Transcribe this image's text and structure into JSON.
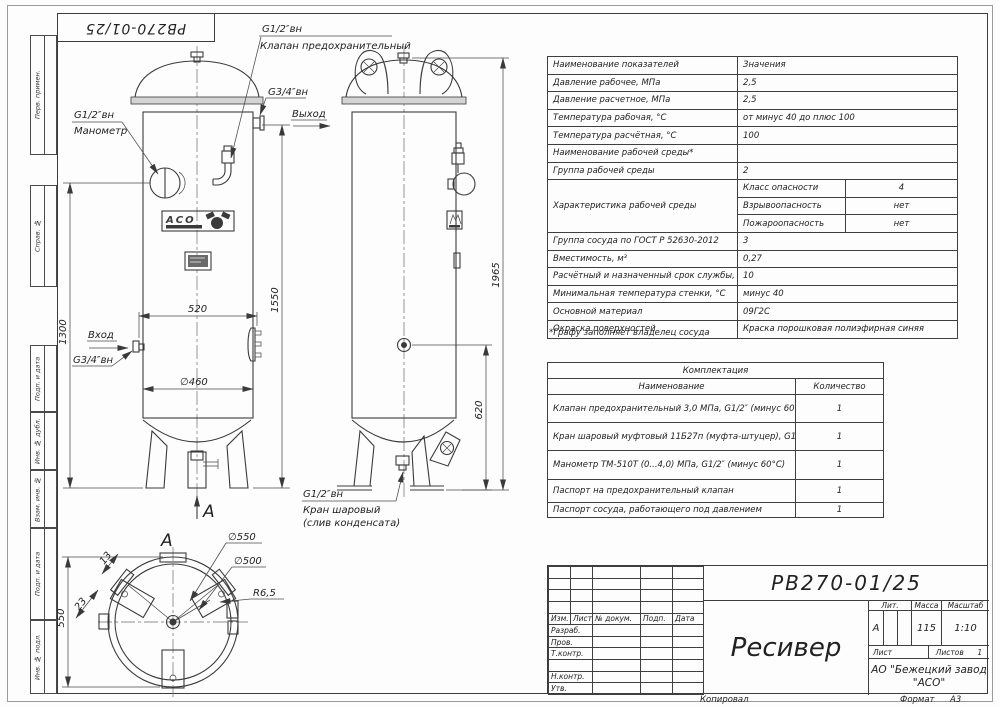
{
  "stamp_top": "РВ270-01/25",
  "margin_labels": [
    "Перв. примен.",
    "Справ. №",
    "Подп. и дата",
    "Инв. № дубл.",
    "Взам. инв. №",
    "Подп. и дата",
    "Инв. № подл."
  ],
  "specs": {
    "rows": [
      {
        "label": "Наименование показателей",
        "value": "Значения"
      },
      {
        "label": "Давление рабочее, МПа",
        "value": "2,5"
      },
      {
        "label": "Давление расчетное, МПа",
        "value": "2,5"
      },
      {
        "label": "Температура рабочая, °С",
        "value": "от минус 40 до плюс 100"
      },
      {
        "label": "Температура расчётная, °С",
        "value": "100"
      },
      {
        "label": "Наименование рабочей среды*",
        "value": ""
      },
      {
        "label": "Группа рабочей среды",
        "value": "2"
      }
    ],
    "group_label": "Характеристика рабочей среды",
    "group_rows": [
      {
        "label": "Класс опасности",
        "value": "4"
      },
      {
        "label": "Взрывоопасность",
        "value": "нет"
      },
      {
        "label": "Пожароопасность",
        "value": "нет"
      }
    ],
    "rows2": [
      {
        "label": "Группа сосуда по ГОСТ Р 52630-2012",
        "value": "3"
      },
      {
        "label": "Вместимость, м³",
        "value": "0,27"
      },
      {
        "label": "Расчётный и назначенный срок службы, лет",
        "value": "10"
      },
      {
        "label": "Минимальная температура стенки, °С",
        "value": "минус 40"
      },
      {
        "label": "Основной материал",
        "value": "09Г2С"
      },
      {
        "label": "Окраска поверхностей",
        "value": "Краска порошковая полиэфирная синяя"
      }
    ],
    "footnote": "*Графу заполняет владелец сосуда"
  },
  "kit": {
    "title": "Комплектация",
    "header": {
      "name": "Наименование",
      "qty": "Количество"
    },
    "rows": [
      {
        "name": "Клапан предохранительный 3,0 МПа, G1/2″ (минус 60°С)",
        "qty": "1"
      },
      {
        "name": "Кран шаровый муфтовый 11Б27п (муфта-штуцер), G1/2″",
        "qty": "1"
      },
      {
        "name": "Манометр ТМ-510Т (0...4,0) МПа, G1/2″ (минус 60°С)",
        "qty": "1"
      },
      {
        "name": "Паспорт на предохранительный клапан",
        "qty": "1"
      },
      {
        "name": "Паспорт сосуда, работающего под давлением",
        "qty": "1"
      }
    ]
  },
  "title_block": {
    "doc_number": "РВ270-01/25",
    "title": "Ресивер",
    "col_headers": [
      "Изм.",
      "Лист",
      "№ докум.",
      "Подп.",
      "Дата"
    ],
    "row_labels": [
      "Разраб.",
      "Пров.",
      "Т.контр.",
      "Н.контр.",
      "Утв."
    ],
    "lit_label": "Лит.",
    "mass_label": "Масса",
    "scale_label": "Масштаб",
    "lit": "А",
    "mass": "115",
    "scale": "1:10",
    "sheet_label": "Лист",
    "sheets_label": "Листов",
    "sheets": "1",
    "company_line1": "АО \"Бежецкий завод",
    "company_line2": "\"АСО\"",
    "copied_label": "Копировал",
    "format_label": "Формат",
    "format": "А3"
  },
  "drawing": {
    "section": "А",
    "logo": "АСО",
    "callouts": {
      "valve_size": "G1/2″вн",
      "valve_name": "Клапан предохранительный",
      "mano_size": "G1/2″вн",
      "mano_name": "Манометр",
      "outlet_size": "G3/4″вн",
      "outlet": "Выход",
      "inlet": "Вход",
      "inlet_size": "G3/4″вн",
      "drain_size": "G1/2″вн",
      "drain_name": "Кран шаровый",
      "drain_name2": "(слив конденсата)"
    },
    "dims": {
      "width": "520",
      "diameter": "∅460",
      "h1300": "1300",
      "h1550": "1550",
      "h1965": "1965",
      "h620": "620",
      "d550": "∅550",
      "d500": "∅500",
      "r": "R6,5",
      "base": "550",
      "a23": "23",
      "a13": "13"
    }
  }
}
